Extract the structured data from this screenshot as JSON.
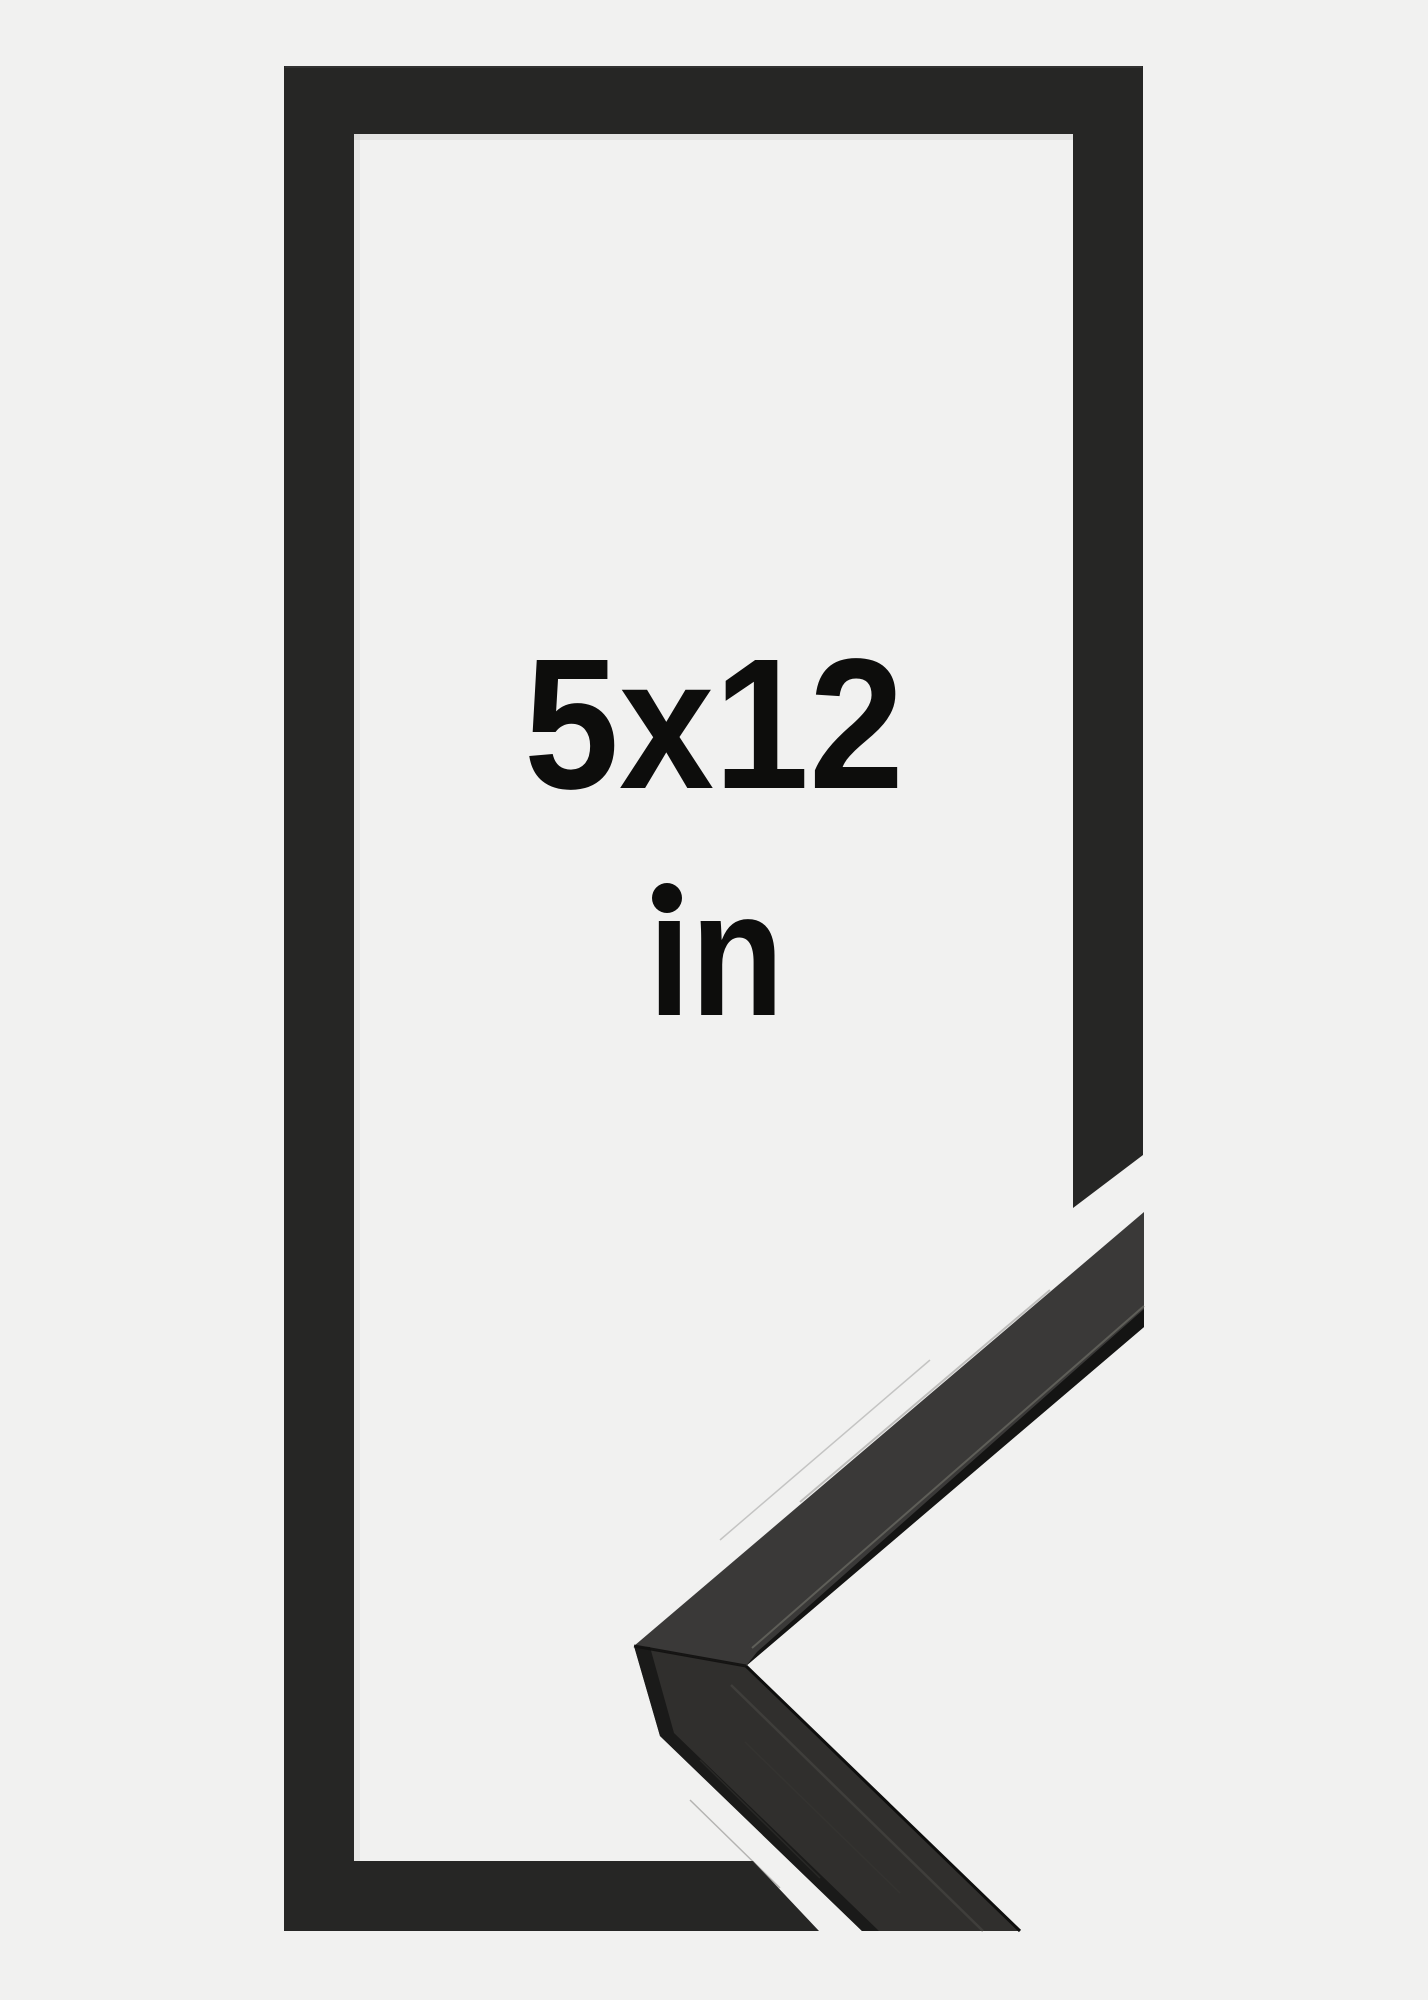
{
  "image": {
    "background_color": "#f1f1f0",
    "frame_color": "#262625",
    "moulding_top_color": "#3a3938",
    "moulding_front_color": "#302f2d",
    "text_color": "#0d0d0c",
    "label": {
      "size": "5x12",
      "unit": "in"
    }
  }
}
